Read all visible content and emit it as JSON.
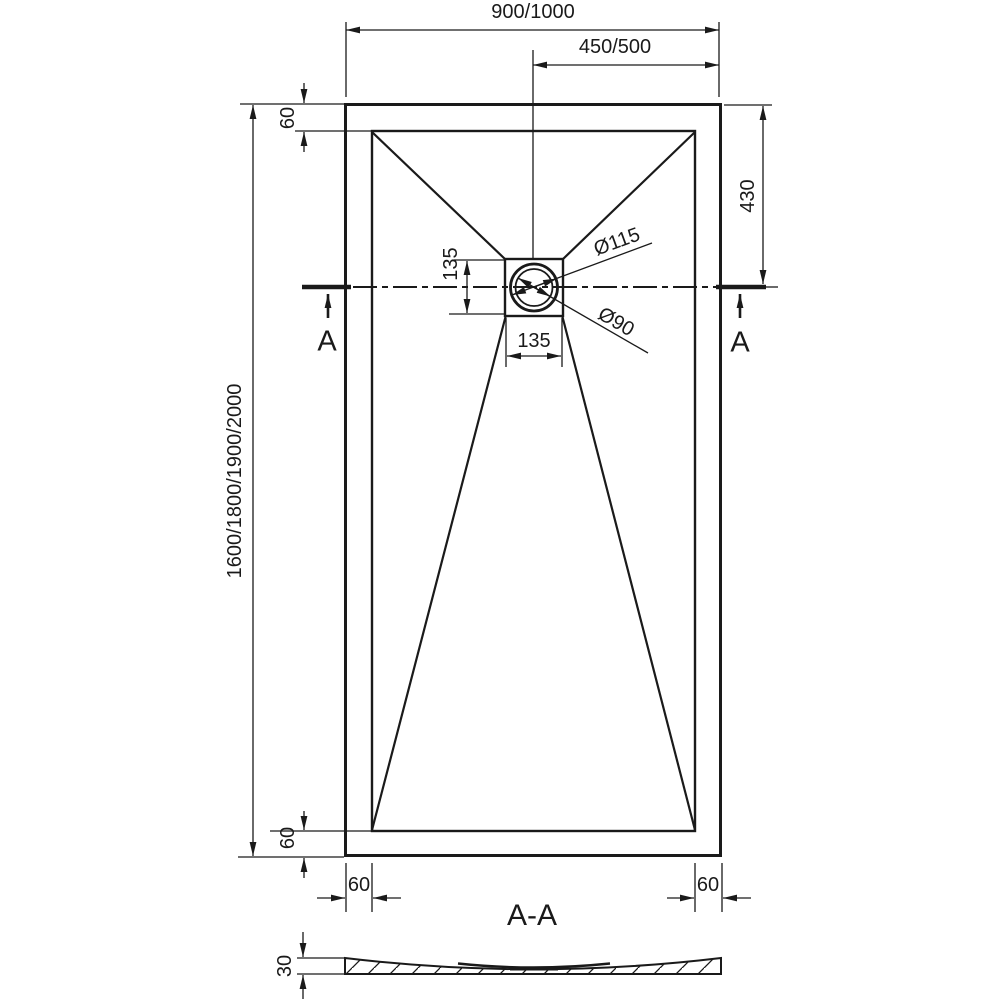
{
  "meta": {
    "background": "#ffffff",
    "line_color": "#1a1a1a",
    "drawing_type": "shower tray technical dimension drawing"
  },
  "drawing": {
    "plan": {
      "width_overall": "900/1000",
      "width_to_drain": "450/500",
      "rim_top": "60",
      "drain_offset_right": "430",
      "length_overall": "1600/1800/1900/2000",
      "drain_box_height": "135",
      "drain_box_width": "135",
      "drain_outer_dia": "Ø115",
      "drain_inner_dia": "Ø90",
      "rim_bottom": "60",
      "rim_bottom_left": "60",
      "rim_bottom_right": "60",
      "section_marker_left": "A",
      "section_marker_right": "A"
    },
    "section": {
      "title": "A-A",
      "thickness": "30"
    }
  }
}
